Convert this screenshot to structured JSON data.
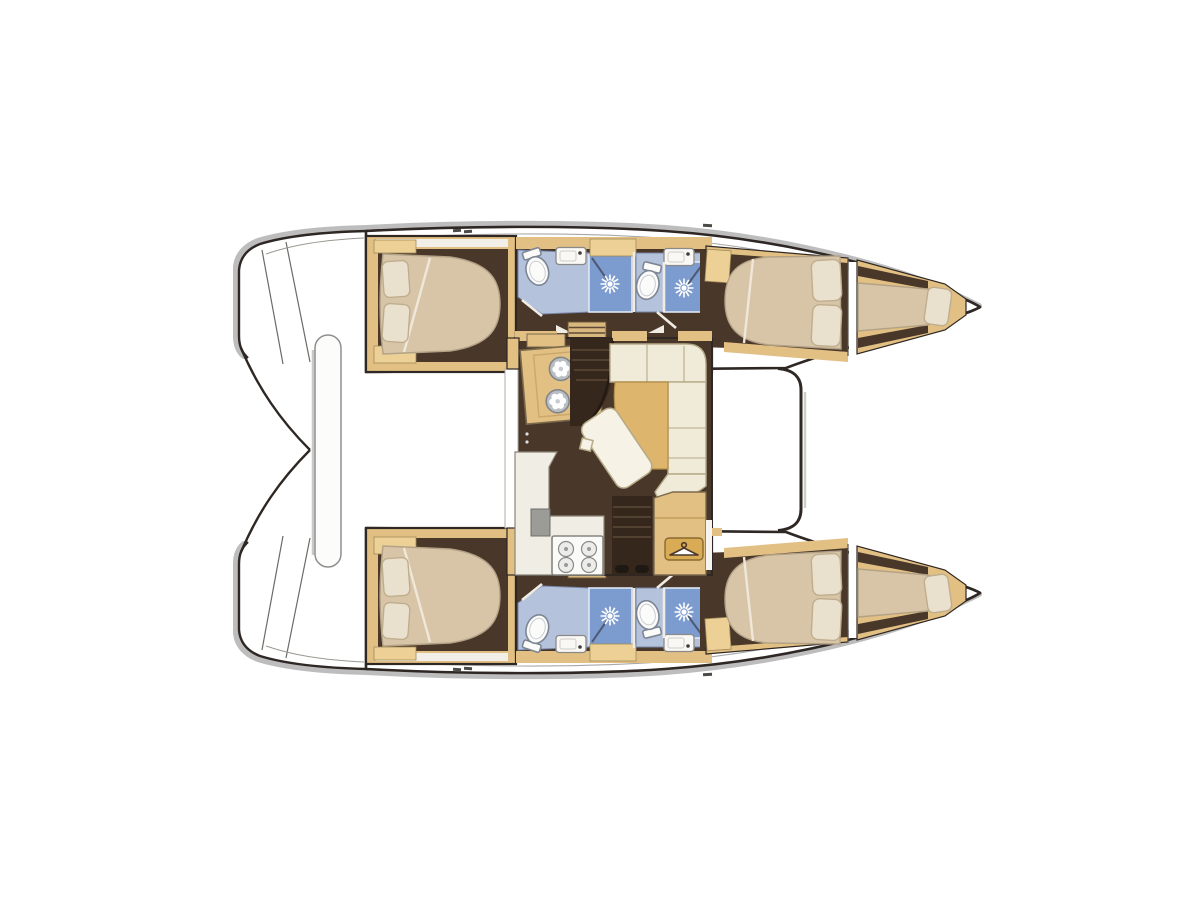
{
  "meta": {
    "title": "Catamaran yacht interior layout — top-view floor plan, bows pointing right",
    "diagram_type": "yacht floor plan",
    "hulls": 2
  },
  "palette": {
    "outline": "#2e2723",
    "shadow": "#bdbdbd",
    "deckline": "#a8a8a8",
    "floor": "#49372a",
    "stairsDark": "#35271c",
    "wood": "#e2bf83",
    "woodLight": "#ecd096",
    "woodSteps": "#d9b87e",
    "plaque": "#d9ab55",
    "mattress": "#d8c5a7",
    "pillow": "#e9e0cd",
    "pillowEdge": "#bfae8e",
    "cream": "#f0ead9",
    "creamEdge": "#b7aa88",
    "seatTan": "#ddb56c",
    "bathFloor": "#b5c2dc",
    "shower": "#7c9bce",
    "counter": "#f0ede4"
  },
  "rooms": {
    "saloon": {
      "features": [
        "galley unit with twin round basins",
        "companionway steps to port hull",
        "L-shaped dinette settee with angled table",
        "forward galley counter with 4-burner stove",
        "companionway steps to starboard hull",
        "hanging locker with clothes-hanger symbol"
      ]
    },
    "port_hull": {
      "aft_cabin": "double island berth with two pillows",
      "bathroom_aft": {
        "fixtures": [
          "toilet",
          "washbasin",
          "shower with spray symbol"
        ]
      },
      "bathroom_fwd": {
        "fixtures": [
          "toilet",
          "washbasin",
          "shower with spray symbol"
        ]
      },
      "forward_cabin": "double berth with two pillows",
      "forepeak": "single bow berth with pillow"
    },
    "starboard_hull": {
      "aft_cabin": "double island berth with two pillows",
      "bathroom_aft": {
        "fixtures": [
          "toilet",
          "washbasin",
          "shower with spray symbol"
        ]
      },
      "bathroom_fwd": {
        "fixtures": [
          "toilet",
          "washbasin",
          "shower with spray symbol"
        ]
      },
      "forward_cabin": "double berth with two pillows",
      "forepeak": "single bow berth with pillow"
    },
    "exterior": {
      "stern": "twin transom platforms with step lines",
      "aft_beam": "vertical rounded cockpit table / beam between sterns"
    }
  },
  "counts": {
    "cabins": 4,
    "bathrooms": 4,
    "showers": 4,
    "toilets": 4,
    "washbasins": 4,
    "forepeak_berths": 2
  },
  "icons": {
    "shower_icon": "white sun-spray symbol on blue shower pan (x4)",
    "hanger_icon": "clothes hanger on tan plaque",
    "burner_icon": "four burner rings on stove",
    "basin_icon": "two round basins with petal drains"
  }
}
